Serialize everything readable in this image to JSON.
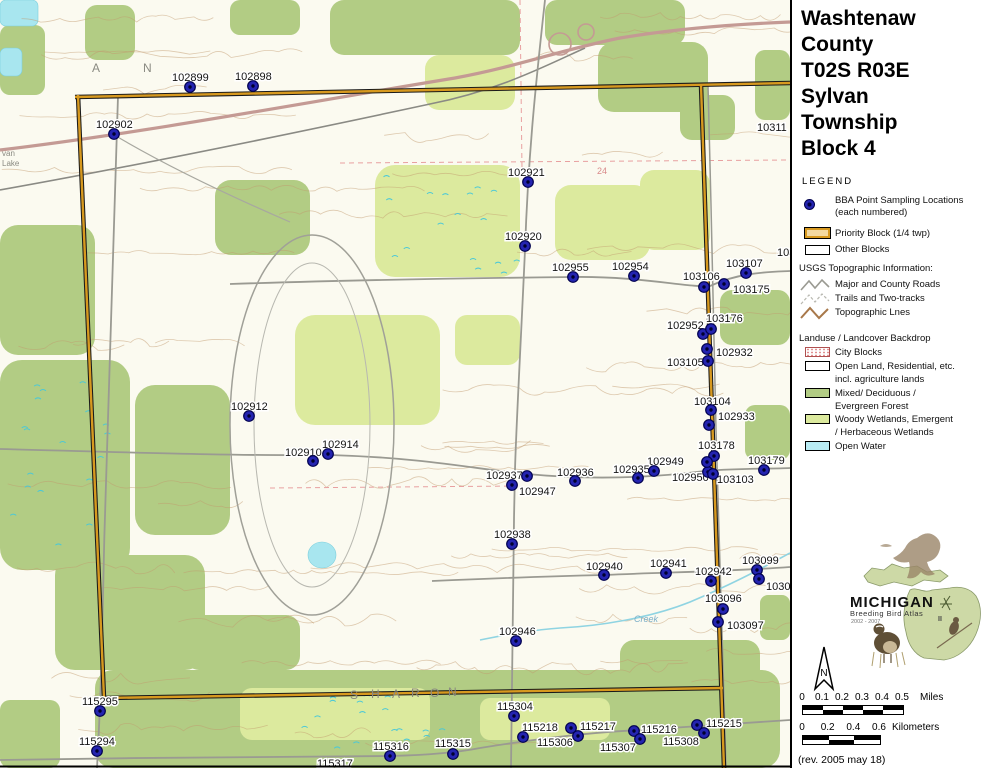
{
  "panel": {
    "title_lines": [
      "Washtenaw",
      "County",
      "T02S R03E",
      "Sylvan",
      "Township",
      "Block 4"
    ],
    "legend": {
      "heading": "LEGEND",
      "bba_line1": "BBA Point Sampling Locations",
      "bba_line2": "(each numbered)",
      "priority": "Priority Block (1/4 twp)",
      "other": "Other Blocks",
      "usgs_header": "USGS Topographic Information:",
      "major_roads": "Major and County Roads",
      "trails": "Trails and Two-tracks",
      "topo": "Topographic Lnes",
      "landuse_header": "Landuse / Landcover Backdrop",
      "city": "City Blocks",
      "open1": "Open Land, Residential, etc.",
      "open2": "incl. agriculture lands",
      "mixed1": "Mixed/ Deciduous /",
      "mixed2": "Evergreen Forest",
      "woody1": "Woody Wetlands, Emergent",
      "woody2": "/ Herbaceous Wetlands",
      "water": "Open Water"
    },
    "logo": {
      "name": "MICHIGAN",
      "subtitle": "Breeding Bird Atlas",
      "years": "2002 - 2007",
      "numeral": "II"
    },
    "compass_label": "N",
    "scale": {
      "miles_ticks": [
        "0",
        "0.1",
        "0.2",
        "0.3",
        "0.4",
        "0.5"
      ],
      "miles_unit": "Miles",
      "km_ticks": [
        "0",
        "0.2",
        "0.4",
        "0.6"
      ],
      "km_unit": "Kilometers"
    },
    "revision": "(rev. 2005 may 18)"
  },
  "map": {
    "colors": {
      "forest": "#b2cc84",
      "wetland": "#dcea9e",
      "water": "#a8e6ef",
      "priority_block": "#d7991f",
      "sampling_dot": "#2424b0",
      "contour": "#c29a6e"
    },
    "points": [
      {
        "id": "102899",
        "dot": [
          190,
          87
        ],
        "label": [
          172,
          81
        ]
      },
      {
        "id": "102898",
        "dot": [
          253,
          86
        ],
        "label": [
          235,
          80
        ]
      },
      {
        "id": "102902",
        "dot": [
          114,
          134
        ],
        "label": [
          96,
          128
        ]
      },
      {
        "id": "102921",
        "dot": [
          528,
          182
        ],
        "label": [
          508,
          176
        ]
      },
      {
        "id": "102920",
        "dot": [
          525,
          246
        ],
        "label": [
          505,
          240
        ]
      },
      {
        "id": "102955",
        "dot": [
          573,
          277
        ],
        "label": [
          552,
          271
        ]
      },
      {
        "id": "102954",
        "dot": [
          634,
          276
        ],
        "label": [
          612,
          270
        ]
      },
      {
        "id": "103106",
        "dot": [
          704,
          287
        ],
        "label": [
          683,
          280
        ]
      },
      {
        "id": "103107",
        "dot": [
          746,
          273
        ],
        "label": [
          726,
          267
        ]
      },
      {
        "id": "103175",
        "dot": [
          724,
          284
        ],
        "label": [
          733,
          293
        ]
      },
      {
        "id": "102952",
        "dot": [
          703,
          334
        ],
        "label": [
          667,
          329
        ]
      },
      {
        "id": "103176",
        "dot": [
          711,
          329
        ],
        "label": [
          706,
          322
        ]
      },
      {
        "id": "102932",
        "dot": [
          707,
          349
        ],
        "label": [
          716,
          356
        ]
      },
      {
        "id": "103105",
        "dot": [
          708,
          361
        ],
        "label": [
          667,
          366
        ]
      },
      {
        "id": "103104",
        "dot": [
          711,
          410
        ],
        "label": [
          694,
          405
        ]
      },
      {
        "id": "102933",
        "dot": [
          709,
          425
        ],
        "label": [
          718,
          420
        ]
      },
      {
        "id": "103178",
        "dot": [
          714,
          456
        ],
        "label": [
          698,
          449
        ]
      },
      {
        "id": "102949",
        "dot": [
          654,
          471
        ],
        "label": [
          647,
          465
        ]
      },
      {
        "id": "102950",
        "dot": [
          708,
          472
        ],
        "label": [
          672,
          481
        ]
      },
      {
        "id": "103103",
        "dot": [
          713,
          474
        ],
        "label": [
          717,
          483
        ]
      },
      {
        "id": "103179",
        "dot": [
          764,
          470
        ],
        "label": [
          748,
          464
        ]
      },
      {
        "id": "102936",
        "dot": [
          575,
          481
        ],
        "label": [
          557,
          476
        ]
      },
      {
        "id": "102935",
        "dot": [
          638,
          478
        ],
        "label": [
          613,
          473
        ]
      },
      {
        "id": "102937",
        "dot": [
          527,
          476
        ],
        "label": [
          486,
          479
        ]
      },
      {
        "id": "102947",
        "dot": [
          512,
          485
        ],
        "label": [
          519,
          495
        ]
      },
      {
        "id": "102910",
        "dot": [
          313,
          461
        ],
        "label": [
          285,
          456
        ]
      },
      {
        "id": "102914",
        "dot": [
          328,
          454
        ],
        "label": [
          322,
          448
        ]
      },
      {
        "id": "102912",
        "dot": [
          249,
          416
        ],
        "label": [
          231,
          410
        ]
      },
      {
        "id": "102938",
        "dot": [
          512,
          544
        ],
        "label": [
          494,
          538
        ]
      },
      {
        "id": "102940",
        "dot": [
          604,
          575
        ],
        "label": [
          586,
          570
        ]
      },
      {
        "id": "102941",
        "dot": [
          666,
          573
        ],
        "label": [
          650,
          567
        ]
      },
      {
        "id": "102942",
        "dot": [
          711,
          581
        ],
        "label": [
          695,
          575
        ]
      },
      {
        "id": "103099",
        "dot": [
          757,
          570
        ],
        "label": [
          742,
          564
        ]
      },
      {
        "id": "103096",
        "dot": [
          723,
          609
        ],
        "label": [
          705,
          602
        ]
      },
      {
        "id": "103097",
        "dot": [
          718,
          622
        ],
        "label": [
          727,
          629
        ]
      },
      {
        "id": "102946",
        "dot": [
          516,
          641
        ],
        "label": [
          499,
          635
        ]
      },
      {
        "id": "115295",
        "dot": [
          100,
          711
        ],
        "label": [
          82,
          705
        ]
      },
      {
        "id": "115294",
        "dot": [
          97,
          751
        ],
        "label": [
          79,
          745
        ]
      },
      {
        "id": "115304",
        "dot": [
          514,
          716
        ],
        "label": [
          497,
          710
        ]
      },
      {
        "id": "115218",
        "dot": [
          523,
          737
        ],
        "label": [
          522,
          731
        ]
      },
      {
        "id": "115217",
        "dot": [
          571,
          728
        ],
        "label": [
          580,
          730
        ]
      },
      {
        "id": "115306",
        "dot": [
          578,
          736
        ],
        "label": [
          537,
          746
        ]
      },
      {
        "id": "115216",
        "dot": [
          634,
          731
        ],
        "label": [
          641,
          733
        ]
      },
      {
        "id": "115307",
        "dot": [
          640,
          739
        ],
        "label": [
          600,
          751
        ]
      },
      {
        "id": "115215",
        "dot": [
          697,
          725
        ],
        "label": [
          706,
          727
        ]
      },
      {
        "id": "115308",
        "dot": [
          704,
          733
        ],
        "label": [
          663,
          745
        ]
      },
      {
        "id": "115316",
        "dot": [
          390,
          756
        ],
        "label": [
          373,
          750
        ]
      },
      {
        "id": "115315",
        "dot": [
          453,
          754
        ],
        "label": [
          435,
          747
        ]
      }
    ],
    "extra_dots": [
      [
        707,
        462
      ],
      [
        759,
        579
      ]
    ],
    "partial_labels": [
      {
        "text": "10311",
        "x": 757,
        "y": 131
      },
      {
        "text": "103",
        "x": 777,
        "y": 256
      },
      {
        "text": "1030",
        "x": 766,
        "y": 590
      },
      {
        "text": "115317",
        "x": 317,
        "y": 767
      }
    ],
    "letters": [
      {
        "t": "A",
        "x": 92,
        "y": 72
      },
      {
        "t": "N",
        "x": 143,
        "y": 72
      },
      {
        "t": "S",
        "x": 350,
        "y": 699
      },
      {
        "t": "H",
        "x": 371,
        "y": 698
      },
      {
        "t": "A",
        "x": 392,
        "y": 698
      },
      {
        "t": "R",
        "x": 411,
        "y": 697
      },
      {
        "t": "O",
        "x": 430,
        "y": 697
      },
      {
        "t": "N",
        "x": 448,
        "y": 696
      },
      {
        "t": "24",
        "x": 597,
        "y": 174,
        "c": "#d98a8a",
        "s": 9
      },
      {
        "t": "Creek",
        "x": 634,
        "y": 622,
        "c": "#7aaec8",
        "s": 9,
        "i": true
      },
      {
        "t": "van",
        "x": 2,
        "y": 156,
        "s": 8
      },
      {
        "t": "Lake",
        "x": 2,
        "y": 166,
        "s": 8
      }
    ]
  }
}
